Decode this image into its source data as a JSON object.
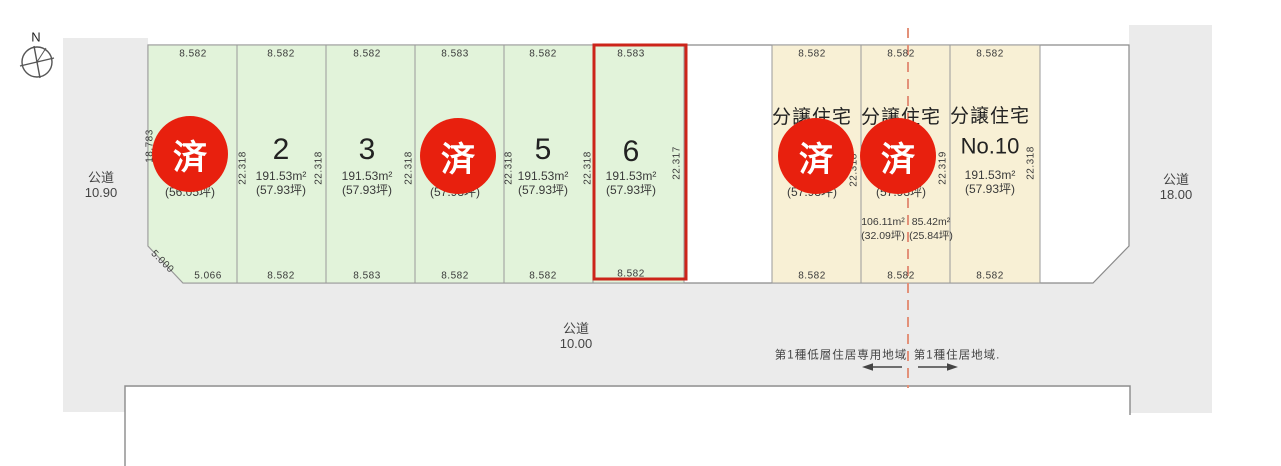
{
  "compass": {
    "label": "N"
  },
  "stamp": {
    "label": "済"
  },
  "roads": {
    "left": {
      "name": "公道",
      "width": "10.90"
    },
    "bottom": {
      "name": "公道",
      "width": "10.00"
    },
    "right": {
      "name": "公道",
      "width": "18.00"
    }
  },
  "zoning": {
    "left_area": "第1種低層住居専用地域",
    "right_area": "第1種住居地域."
  },
  "colors": {
    "plot_green": "#e2f3da",
    "plot_beige": "#f8f0d5",
    "road_gray": "#ebebeb",
    "stamp_red": "#e8200e",
    "highlight_red": "#cc241a",
    "zoning_dash": "#e39179"
  },
  "plots": {
    "p1": {
      "sold": true,
      "top": "8.582",
      "bottom": "5.066",
      "corner": "5.000",
      "side_left": "18.783",
      "area_tsubo": "(56.05坪)"
    },
    "p2": {
      "number": "2",
      "top": "8.582",
      "bottom": "8.582",
      "side_left": "22.318",
      "side_right": "22.318",
      "area_m2": "191.53m²",
      "area_tsubo": "(57.93坪)"
    },
    "p3": {
      "number": "3",
      "top": "8.582",
      "bottom": "8.583",
      "side_right": "22.318",
      "area_m2": "191.53m²",
      "area_tsubo": "(57.93坪)"
    },
    "p4": {
      "sold": true,
      "top": "8.583",
      "bottom": "8.582",
      "side_right": "22.318",
      "area_tsubo": "(57.93坪)"
    },
    "p5": {
      "number": "5",
      "top": "8.582",
      "bottom": "8.582",
      "side_right": "22.318",
      "area_m2": "191.53m²",
      "area_tsubo": "(57.93坪)"
    },
    "p6": {
      "number": "6",
      "highlighted": true,
      "top": "8.583",
      "bottom": "8.582",
      "side_right": "22.317",
      "area_m2": "191.53m²",
      "area_tsubo": "(57.93坪)"
    },
    "p8": {
      "sold": true,
      "title": "分譲住宅",
      "top": "8.582",
      "bottom": "8.582",
      "side_right": "22.318",
      "area_tsubo": "(57.93坪)"
    },
    "p9": {
      "sold": true,
      "title": "分譲住宅",
      "top": "8.582",
      "bottom": "8.582",
      "side_right": "22.319",
      "area_tsubo": "(57.93坪)",
      "sub_left": {
        "area_m2": "106.11m²",
        "area_tsubo": "(32.09坪)"
      },
      "sub_right": {
        "area_m2": "85.42m²",
        "area_tsubo": "(25.84坪)"
      }
    },
    "p10": {
      "title": "分譲住宅",
      "number": "No.10",
      "top": "8.582",
      "bottom": "8.582",
      "side_right": "22.318",
      "area_m2": "191.53m²",
      "area_tsubo": "(57.93坪)"
    }
  }
}
